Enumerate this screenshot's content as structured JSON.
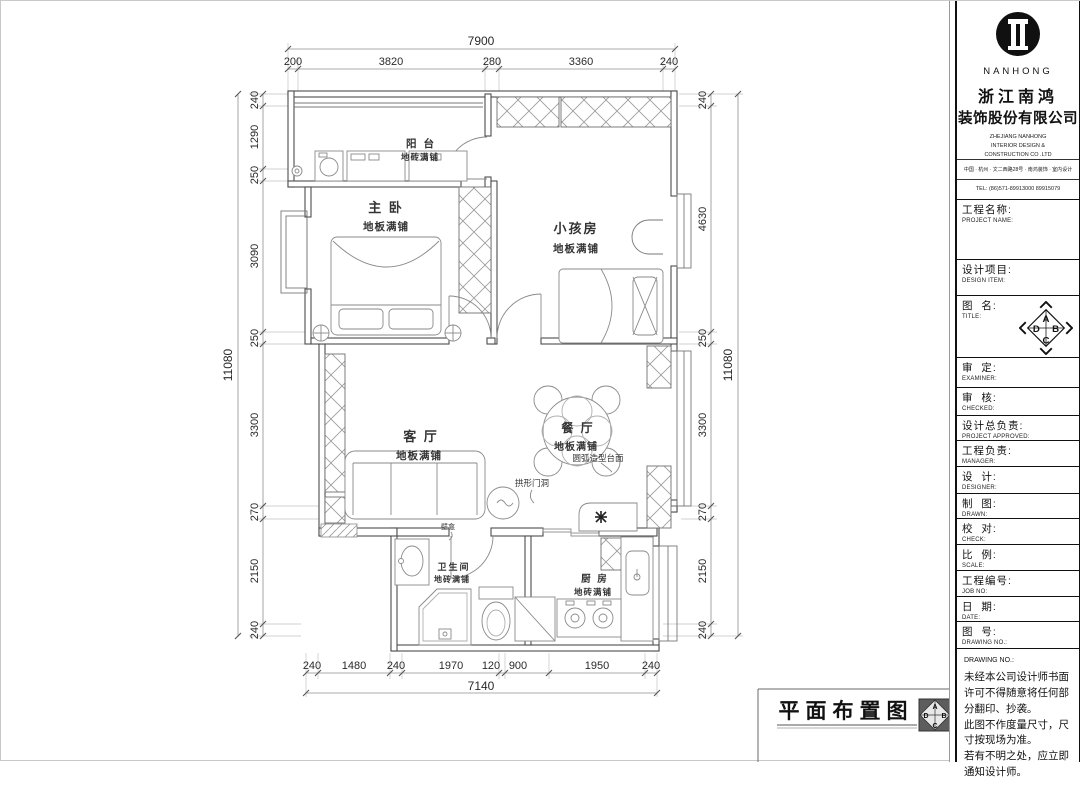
{
  "dims": {
    "top": {
      "total": "7900",
      "segments": [
        "200",
        "3820",
        "280",
        "3360",
        "240"
      ]
    },
    "left": {
      "total": "11080",
      "segments": [
        "240",
        "1290",
        "250",
        "3090",
        "250",
        "3300",
        "270",
        "2150",
        "240"
      ]
    },
    "right": {
      "total": "11080",
      "segments": [
        "240",
        "4630",
        "250",
        "3300",
        "270",
        "2150",
        "240"
      ]
    },
    "bottom": {
      "total": "7140",
      "segments": [
        "240",
        "1480",
        "240",
        "1970",
        "120",
        "900",
        "1950",
        "240"
      ]
    }
  },
  "plan": {
    "rooms": {
      "balcony": {
        "name": "阳 台",
        "finish": "地砖满铺"
      },
      "master": {
        "name": "主 卧",
        "finish": "地板满铺"
      },
      "kids": {
        "name": "小孩房",
        "finish": "地板满铺"
      },
      "living": {
        "name": "客 厅",
        "finish": "地板满铺"
      },
      "dining": {
        "name": "餐 厅",
        "finish": "地板满铺"
      },
      "bath": {
        "name": "卫生间",
        "finish": "地砖满铺"
      },
      "kitchen": {
        "name": "厨 房",
        "finish": "地砖满铺"
      }
    },
    "annotations": {
      "arch": "拱形门洞",
      "counter": "圆弧造型台面",
      "niche": "壁龛"
    },
    "footer_title": "平面布置图"
  },
  "title_block": {
    "brand": {
      "name_en": "NANHONG",
      "name_cn_1": "浙江南鸿",
      "name_cn_2": "装饰股份有限公司",
      "en_full_1": "ZHEJIANG NANHONG",
      "en_full_2": "INTERIOR DESIGN &",
      "en_full_3": "CONSTRUCTION CO .LTD",
      "address": "中国 · 杭州 · 文二西路28号 · 南鸿装饰 · 室内设计",
      "tel": "TEL:  (86)571-89913000  89915079"
    },
    "compass": {
      "a": "A",
      "b": "B",
      "c": "C",
      "d": "D"
    },
    "fields": [
      {
        "cn": "工程名称:",
        "en": "PROJECT NAME:"
      },
      {
        "cn": "设计项目:",
        "en": "DESIGN ITEM:"
      },
      {
        "cn": "图  名:",
        "en": "TITLE:"
      },
      {
        "cn": "审  定:",
        "en": "EXAMINER:"
      },
      {
        "cn": "审  核:",
        "en": "CHECKED:"
      },
      {
        "cn": "设计总负责:",
        "en": "PROJECT APPROVED:"
      },
      {
        "cn": "工程负责:",
        "en": "MANAGER:"
      },
      {
        "cn": "设  计:",
        "en": "DESIGNER:"
      },
      {
        "cn": "制  图:",
        "en": "DRAWN:"
      },
      {
        "cn": "校  对:",
        "en": "CHECK:"
      },
      {
        "cn": "比  例:",
        "en": "SCALE:"
      },
      {
        "cn": "工程编号:",
        "en": "JOB NO:"
      },
      {
        "cn": "日  期:",
        "en": "DATE:"
      },
      {
        "cn": "图  号:",
        "en": "DRAWING NO.:"
      }
    ],
    "note_title": "DRAWING NO.:",
    "note_lines": [
      "未经本公司设计师书面",
      "许可不得随意将任何部",
      "分翻印、抄袭。",
      "此图不作度量尺寸，尺",
      "寸按现场为准。",
      "若有不明之处，应立即",
      "通知设计师。"
    ]
  }
}
